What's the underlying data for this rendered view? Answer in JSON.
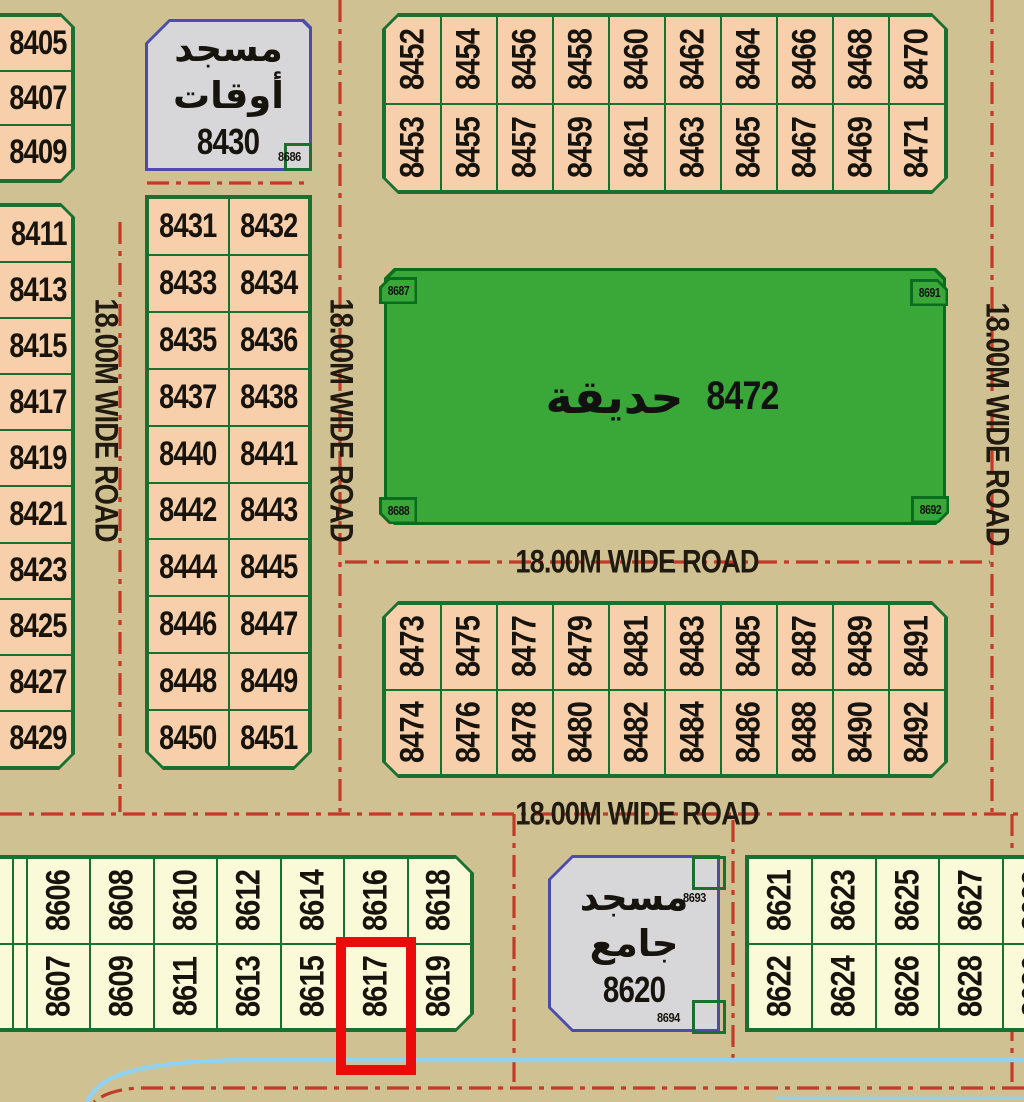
{
  "road_label": "18.00M WIDE ROAD",
  "colors": {
    "background": "#cfc192",
    "plot_fill_salmon": "#f8cfab",
    "plot_fill_cream": "#fbfad8",
    "plot_border_green": "#1a7030",
    "park_fill": "#3aa838",
    "mosque_fill": "#d7d7da",
    "mosque_border": "#4c4cae",
    "road_line_red": "#c23a28",
    "highlight_red": "#ec0b0b",
    "stream_blue": "#93d2ee"
  },
  "blocks": {
    "left_top": {
      "plots": [
        "8405",
        "8407",
        "8409"
      ]
    },
    "left_bottom": {
      "plots": [
        "8411",
        "8413",
        "8415",
        "8417",
        "8419",
        "8421",
        "8423",
        "8425",
        "8427",
        "8429"
      ]
    },
    "mosque_awqaf": {
      "name_line1": "مسجد",
      "name_line2": "أوقات",
      "number": "8430",
      "corner_plot": "8686"
    },
    "mid_column": {
      "rows": [
        [
          "8431",
          "8432"
        ],
        [
          "8433",
          "8434"
        ],
        [
          "8435",
          "8436"
        ],
        [
          "8437",
          "8438"
        ],
        [
          "8440",
          "8441"
        ],
        [
          "8442",
          "8443"
        ],
        [
          "8444",
          "8445"
        ],
        [
          "8446",
          "8447"
        ],
        [
          "8448",
          "8449"
        ],
        [
          "8450",
          "8451"
        ]
      ]
    },
    "top_strip": {
      "row1": [
        "8452",
        "8454",
        "8456",
        "8458",
        "8460",
        "8462",
        "8464",
        "8466",
        "8468",
        "8470"
      ],
      "row2": [
        "8453",
        "8455",
        "8457",
        "8459",
        "8461",
        "8463",
        "8465",
        "8467",
        "8469",
        "8471"
      ]
    },
    "park": {
      "name": "حديقة",
      "number": "8472",
      "corner_tl": "8687",
      "corner_tr": "8691",
      "corner_bl": "8688",
      "corner_br": "8692"
    },
    "mid_strip": {
      "row1": [
        "8473",
        "8475",
        "8477",
        "8479",
        "8481",
        "8483",
        "8485",
        "8487",
        "8489",
        "8491"
      ],
      "row2": [
        "8474",
        "8476",
        "8478",
        "8480",
        "8482",
        "8484",
        "8486",
        "8488",
        "8490",
        "8492"
      ]
    },
    "bottom_left": {
      "row1": [
        "",
        "",
        "8606",
        "8608",
        "8610",
        "8612",
        "8614",
        "8616",
        "8618"
      ],
      "row2": [
        "",
        "",
        "8607",
        "8609",
        "8611",
        "8613",
        "8615",
        "8617",
        "8619"
      ]
    },
    "mosque_jami": {
      "name_line1": "مسجد",
      "name_line2": "جامع",
      "number": "8620",
      "corner_plot_top": "8693",
      "corner_plot_bottom": "8694"
    },
    "bottom_right": {
      "row1": [
        "8621",
        "8623",
        "8625",
        "8627",
        "8629"
      ],
      "row2": [
        "8622",
        "8624",
        "8626",
        "8628",
        "8630"
      ]
    }
  },
  "highlight": {
    "plot": "8617"
  }
}
